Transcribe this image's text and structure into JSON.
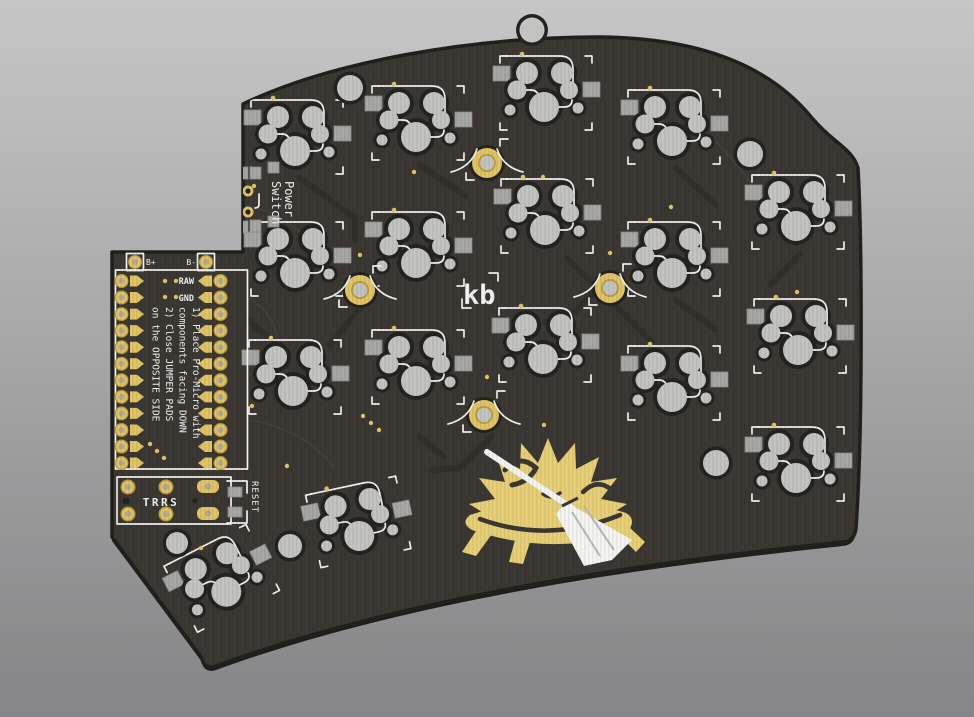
{
  "scene": {
    "description": "3D render of a split ergonomic keyboard PCB, back side, with hotswap key footprints",
    "board_name": "kb hedgehog keyboard PCB"
  },
  "colors": {
    "bg_top": "#c6c6c7",
    "bg_bottom": "#858587",
    "pcb": "#3b3833",
    "pcb_dark": "#21201d",
    "pcb_side": "#1f1e1b",
    "hole_silver": "#c3c3c1",
    "hole_shadow": "#242320",
    "pad_gray": "#a7a7a4",
    "gold": "#e0c466",
    "gold_deep": "#bd9c3e",
    "silk": "#f2f2f0",
    "trace": "#312f2a",
    "art_gold": "#e7cf78"
  },
  "silkscreen": {
    "power_switch_lines": [
      "Power",
      "Switch"
    ],
    "labels": {
      "b_plus": "B+",
      "b_minus": "B-",
      "raw": "RAW",
      "gnd": "GND",
      "trrs": "TRRS",
      "reset": "RESET"
    },
    "instructions_lines": [
      "1) Place Pro-Micro with",
      "components facing DOWN",
      "2) Close JUMPER PADS",
      "on the OPPOSITE SIDE"
    ],
    "logo": "kb"
  },
  "art": {
    "mascot": "hedgehog-with-broom"
  }
}
